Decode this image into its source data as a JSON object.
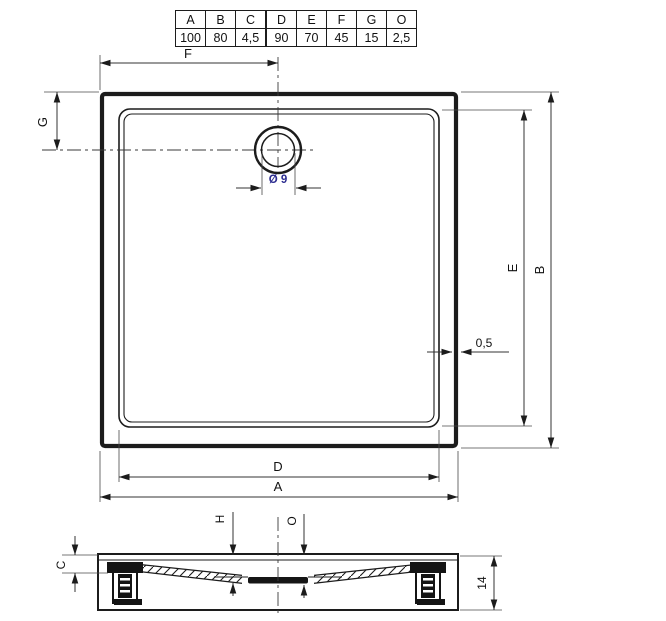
{
  "spec_table": {
    "headers": [
      "A",
      "B",
      "C",
      "D",
      "E",
      "F",
      "G",
      "O"
    ],
    "values": [
      "100",
      "80",
      "4,5",
      "90",
      "70",
      "45",
      "15",
      "2,5"
    ]
  },
  "top_view": {
    "outer_width_label": "A",
    "inner_width_label": "D",
    "outer_height_label": "B",
    "inner_height_label": "E",
    "drain_offset_x_label": "F",
    "drain_offset_y_label": "G",
    "drain_diameter_label": "Ø 9",
    "wall_thickness_label": "0,5"
  },
  "section_view": {
    "rim_height_label": "C",
    "floor_thickness_label": "H",
    "drain_plate_label": "O",
    "total_height_label": "14"
  },
  "colors": {
    "line": "#1c1c1c",
    "dimension": "#333333",
    "drain_text_blue": "#2b2b8f",
    "background": "#ffffff"
  }
}
